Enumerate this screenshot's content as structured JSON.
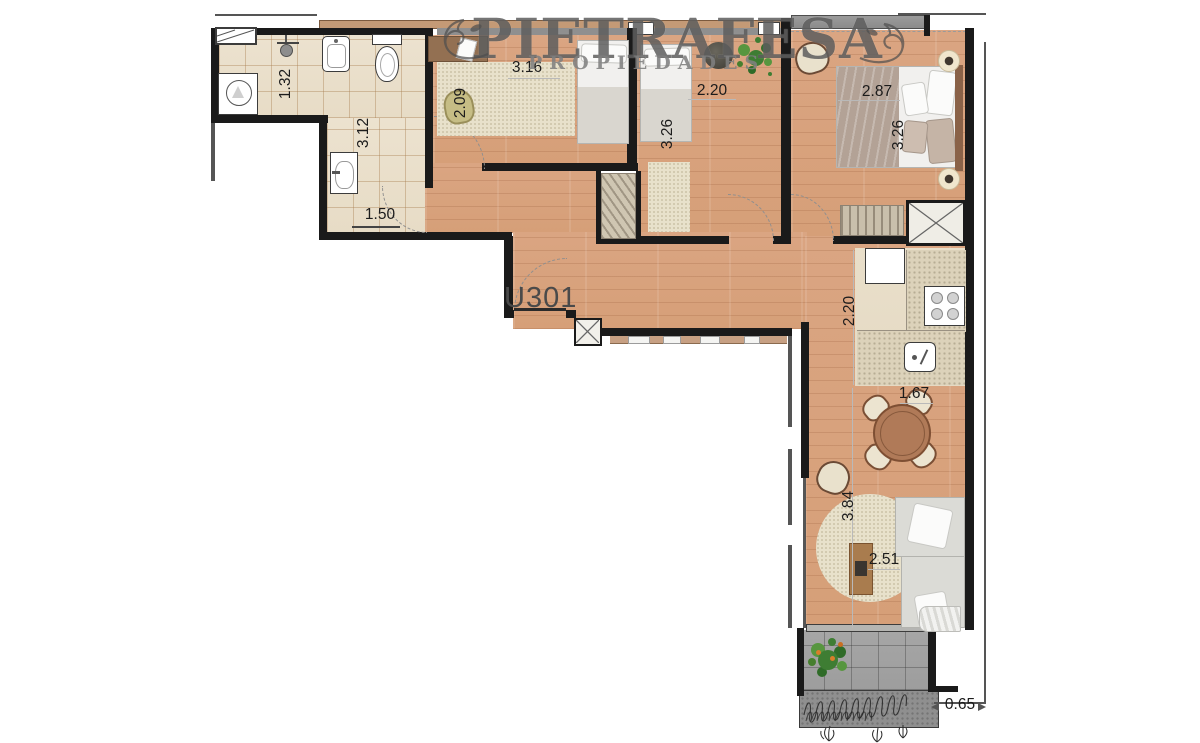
{
  "watermark": {
    "brand": "PIETRAFESA",
    "subtitle": "PROPIEDADES"
  },
  "unit_label": "U301",
  "dimensions": {
    "bathroom_shower_width": "1.32",
    "bathroom_length": "3.12",
    "bathroom_entry_width": "1.50",
    "bedroom1_depth": "2.09",
    "bedroom1_width": "3.16",
    "bedroom2_width": "2.20",
    "bedroom2_depth": "3.26",
    "master_bedroom_width": "2.87",
    "master_bedroom_depth": "3.26",
    "kitchen_depth": "2.20",
    "dining_width": "1.67",
    "living_depth": "3.84",
    "living_width": "2.51",
    "terrace_planter_depth": "0.65"
  },
  "palette": {
    "wood_floor": "#d9a47e",
    "tile_floor": "#e8decb",
    "terrace_floor": "#a0a0a0",
    "wall": "#1a1a1a",
    "rug": "#e8e1cb",
    "dining_table_wood": "#b07a58",
    "plant_green": "#3e7d33",
    "watermark_gray": "#4e4e4e"
  }
}
